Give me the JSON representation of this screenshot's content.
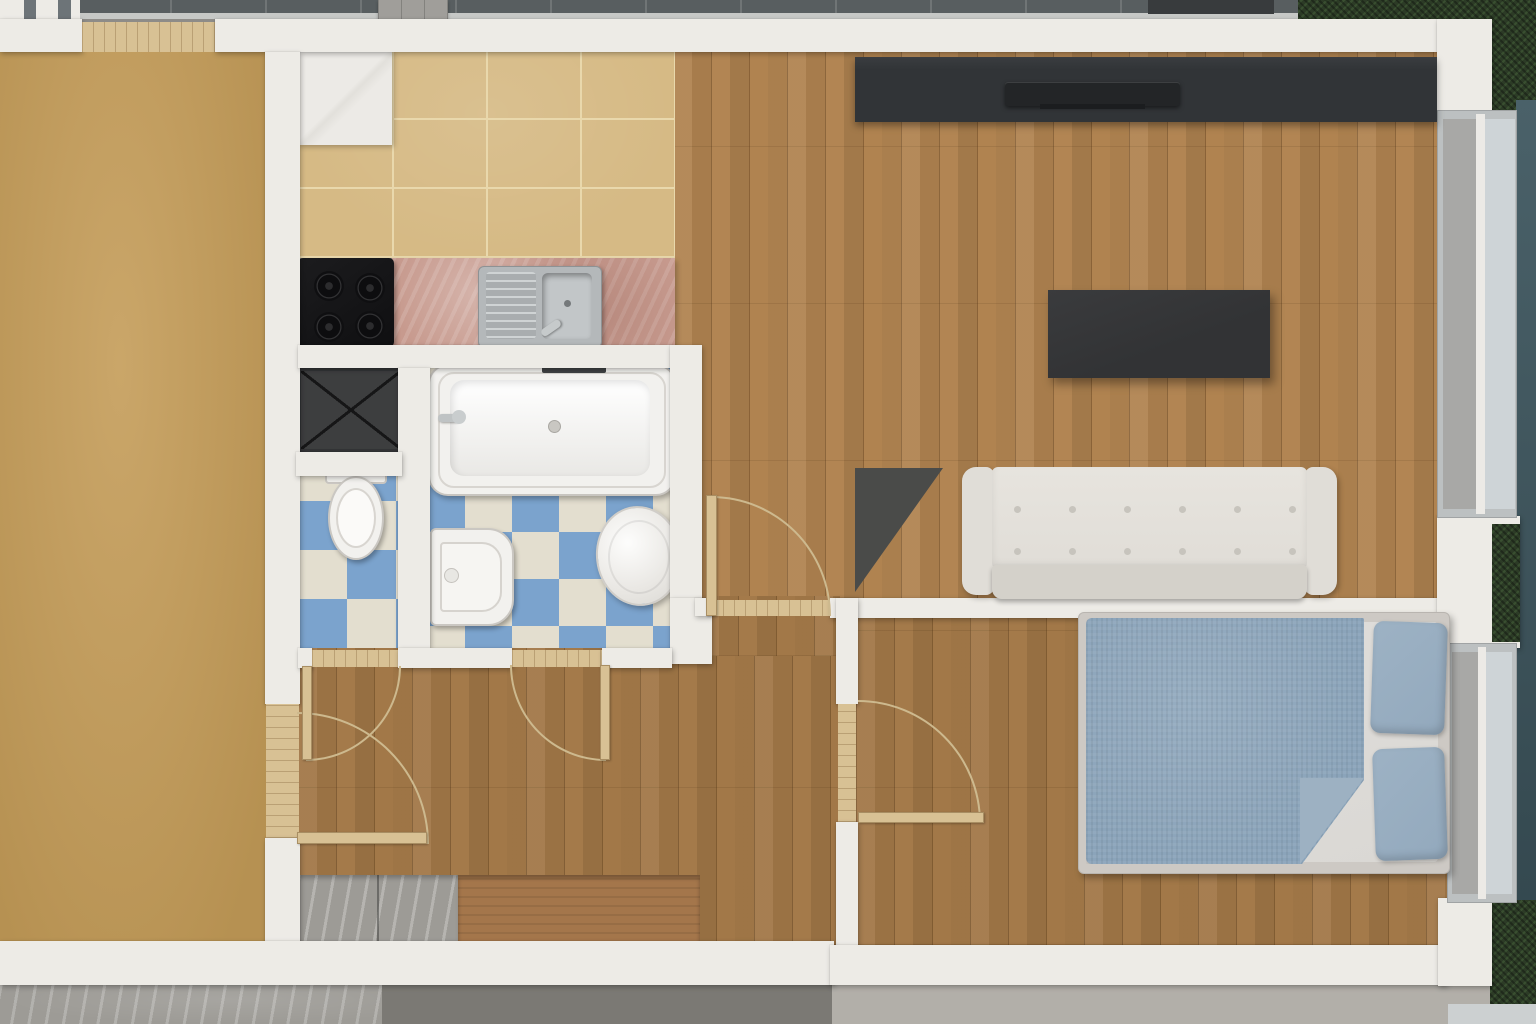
{
  "meta": {
    "title": "Top-down 3D rendered floor plan of a one-bedroom apartment",
    "view": "orthographic top view",
    "canvas": {
      "width": 1536,
      "height": 1024
    }
  },
  "colors": {
    "wall": "#edebe6",
    "tan": "#c49c58",
    "wood": "#b08350",
    "tile": "#d6ba85",
    "grout": "#e9d8ac",
    "checkBlue": "#7ba3cd",
    "checkCream": "#e3decf",
    "counter": "#c79a8e",
    "stove": "#151517",
    "steel": "#b4b8ba",
    "shower": "#3d3e3f",
    "fixture": "#f2f1ee",
    "media": "#313437",
    "tv": "#232527",
    "table": "#323335",
    "triangle": "#4a4b49",
    "sofa": "#e0ddd7",
    "sofaSeat": "#d4d1ca",
    "bedFrame": "#cdc9c4",
    "sheet": "#dad8d4",
    "duvet": "#8ba4ba",
    "duvetFold": "#9db1c2",
    "pillow": "#93a9bd",
    "door": "#d8c194",
    "arc": "#cdb98e",
    "benchWood": "#a4764b",
    "terrace": "#585e60",
    "terraceEdge": "#c6c8c6",
    "grass": "#2c3b26",
    "teal": "#44595f",
    "concL": "#9d9b96",
    "concD": "#7b7974",
    "concWarm": "#b2afa9",
    "glassDark": "#a8a8a6",
    "glassLight": "#ced4d7",
    "frame": "#bcc0c1",
    "mat": "#383b3d",
    "stone": "#a09e9a"
  },
  "rooms": [
    {
      "id": "side-room",
      "label": "Side room",
      "floor": "tan carpet"
    },
    {
      "id": "kitchen",
      "label": "Kitchen",
      "floor": "beige ceramic tile"
    },
    {
      "id": "wc",
      "label": "WC",
      "floor": "blue-white checker tile"
    },
    {
      "id": "bathroom",
      "label": "Bathroom",
      "floor": "blue-white checker tile"
    },
    {
      "id": "hallway",
      "label": "Hallway",
      "floor": "oak plank"
    },
    {
      "id": "living-room",
      "label": "Living room",
      "floor": "oak plank"
    },
    {
      "id": "bedroom",
      "label": "Bedroom",
      "floor": "oak plank"
    }
  ],
  "furniture": {
    "kitchen": [
      "corner cabinet",
      "4-burner cooktop",
      "pink marble countertop",
      "stainless sink with drainboard"
    ],
    "wc": [
      "shower tray with X mark",
      "toilet"
    ],
    "bathroom": [
      "bathtub with faucet",
      "pedestal washbasin",
      "washing machine (round top)"
    ],
    "living_room": [
      "dark media console",
      "flat TV panel",
      "dark coffee table",
      "white tufted sofa",
      "dark triangular mat"
    ],
    "bedroom": [
      "double bed",
      "blue duvet with folded corner",
      "two blue pillows"
    ],
    "hallway": [
      "gray marble doormat tiles",
      "wooden bench strip"
    ]
  },
  "openings": {
    "interior_doors": 5,
    "balcony_threshold": 1,
    "windows": [
      "living room window (east)",
      "bedroom window (east)"
    ]
  },
  "exterior": [
    "dark tiled terrace (north)",
    "hedge grass (north-east, east, south-east)",
    "concrete walkways (south)",
    "teal facade strip (east)"
  ]
}
